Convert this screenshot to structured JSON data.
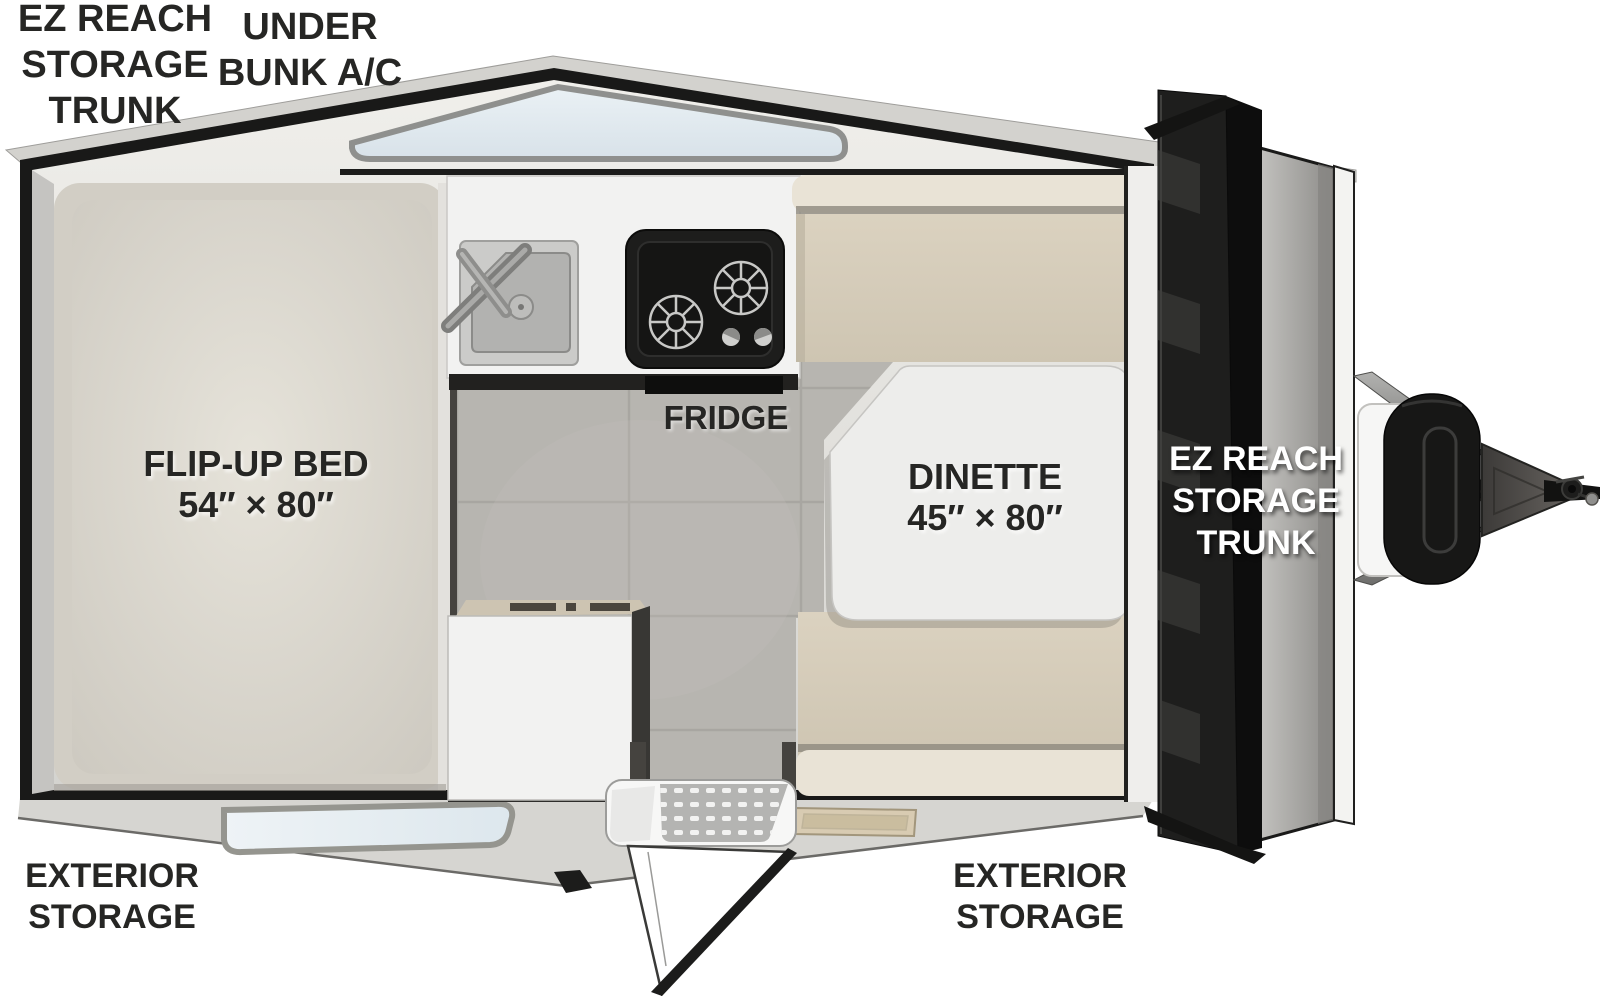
{
  "title": "A-frame camper floorplan",
  "labels": {
    "rear_trunk": [
      "EZ REACH",
      "STORAGE",
      "TRUNK"
    ],
    "under_bunk_ac": [
      "UNDER",
      "BUNK A/C"
    ],
    "flip_up_bed": [
      "FLIP-UP BED",
      "54″ × 80″"
    ],
    "fridge": "FRIDGE",
    "dinette": [
      "DINETTE",
      "45″ × 80″"
    ],
    "front_trunk": [
      "EZ REACH",
      "STORAGE",
      "TRUNK"
    ],
    "exterior_storage_left": [
      "EXTERIOR",
      "STORAGE"
    ],
    "exterior_storage_center": [
      "EXTERIOR",
      "STORAGE"
    ]
  },
  "features": {
    "bed_size": "54″ × 80″",
    "dinette_size": "45″ × 80″",
    "icons": [
      "sink-icon",
      "stove-icon",
      "skylight-window",
      "rear-window",
      "entry-step",
      "entry-door",
      "propane-tank",
      "hitch-coupler",
      "storage-trunk-door",
      "door-mat"
    ]
  },
  "colors": {
    "outline_black": "#1b1b1a",
    "wall_gray": "#d3d2ce",
    "bed_cream": "#e0dcd3",
    "cushion_beige": "#d5ccba",
    "cushion_back": "#e9e3d6",
    "tile_floor": "#b7b5b0",
    "counter_white": "#f2f2f1",
    "glass_blue": "#e4ecf1",
    "label_black": "#262624",
    "label_white": "#ffffff"
  }
}
